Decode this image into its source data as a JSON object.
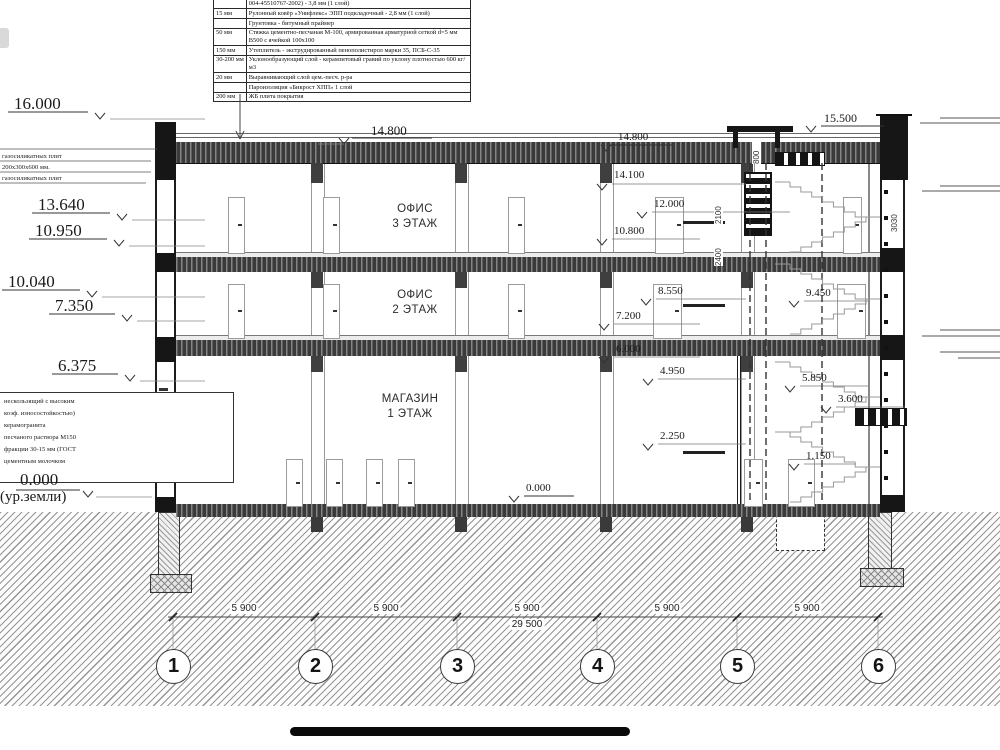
{
  "spec_table": {
    "rows": [
      {
        "th": "5 мм",
        "desc": "Рулонный материал «Унифлекс» ТКП с крупнозернистой посыпкой (ТУ 5774-004-45510767-2002) - 3,8 мм (1 слой)"
      },
      {
        "th": "15 мм",
        "desc": "Рулонный ковёр «Унифлекс» ЭПП подкладочный - 2,8 мм (1 слой)"
      },
      {
        "th": "",
        "desc": "Грунтовка - битумный праймер"
      },
      {
        "th": "50 мм",
        "desc": "Стяжка цементно-песчаная М-100, армированная арматурной сеткой d=5 мм  В500 с ячейкой 100х100"
      },
      {
        "th": "150 мм",
        "desc": "Утеплитель - экструдированный пенополистирол марки 35, ПСБ-С-35"
      },
      {
        "th": "30-200 мм",
        "desc": "Уклонообразующий слой - керамзитовый гравий по уклону плотностью 600 кг/м3"
      },
      {
        "th": "20 мм",
        "desc": "Выравнивающий слой цем.-песч. р-ра"
      },
      {
        "th": "",
        "desc": "Пароизоляция «Бикрост ХПП» 1 слой"
      },
      {
        "th": "200 мм",
        "desc": "ЖБ плита покрытия"
      }
    ]
  },
  "levels": {
    "l16": "16.000",
    "l1364": "13.640",
    "l1095": "10.950",
    "l1004": "10.040",
    "l735": "7.350",
    "l6375": "6.375",
    "ground": "0.000",
    "ground_note": "(ур.земли)",
    "c148": "14.800",
    "c0": "0.000",
    "r155": "15.500",
    "r148": "14.800",
    "r141": "14.100",
    "r120": "12.000",
    "r108": "10.800",
    "r855": "8.550",
    "r72": "7.200",
    "r60": "6.000",
    "r495": "4.950",
    "r225": "2.250",
    "s945": "9.450",
    "s585": "5.850",
    "s36": "3.600",
    "s115": "1.150"
  },
  "dims": {
    "span": "5 900",
    "total": "29 500",
    "v800": "800",
    "v2100": "2100",
    "v2400": "2400",
    "v3030": "3030"
  },
  "axes": [
    "1",
    "2",
    "3",
    "4",
    "5",
    "6"
  ],
  "rooms": {
    "office3_l1": "ОФИС",
    "office3_l2": "3 ЭТАЖ",
    "office2_l1": "ОФИС",
    "office2_l2": "2 ЭТАЖ",
    "shop_l1": "МАГАЗИН",
    "shop_l2": "1 ЭТАЖ"
  },
  "notes_upper": [
    "газосиликатных плит",
    "200х300х600 мм.",
    "газосиликатных плит"
  ],
  "notes_lower": [
    "нескользящий с высоким",
    "коэф. износостойкостью)",
    "керамогранита",
    "песчаного раствора М150",
    "фракции 30-15 мм (ГОСТ",
    "цементным молочком"
  ]
}
